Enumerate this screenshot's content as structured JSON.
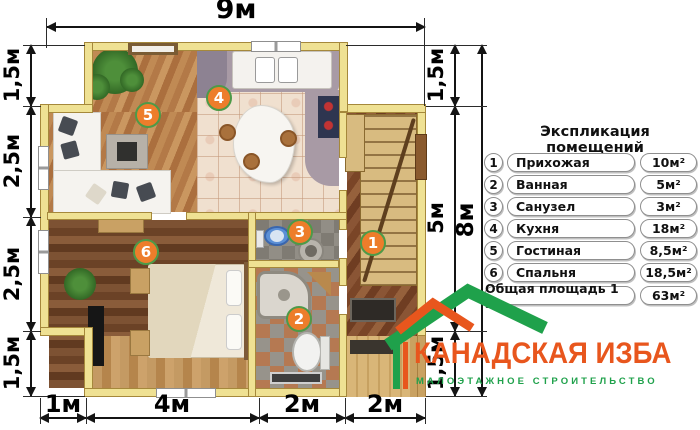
{
  "plan": {
    "dims": {
      "top": {
        "label": "9м"
      },
      "left": [
        {
          "label": "1,5м"
        },
        {
          "label": "2,5м"
        },
        {
          "label": "2,5м"
        },
        {
          "label": "1,5м"
        }
      ],
      "right_inner": [
        {
          "label": "1,5м"
        },
        {
          "label": "5м"
        },
        {
          "label": "1,5м"
        }
      ],
      "right_outer": {
        "label": "8м"
      },
      "bottom": [
        {
          "label": "1м"
        },
        {
          "label": "4м"
        },
        {
          "label": "2м"
        },
        {
          "label": "2м"
        }
      ]
    },
    "markers": [
      "1",
      "2",
      "3",
      "4",
      "5",
      "6"
    ]
  },
  "legend": {
    "title": "Экспликация помещений",
    "rows": [
      {
        "num": "1",
        "name": "Прихожая",
        "area": "10м²"
      },
      {
        "num": "2",
        "name": "Ванная",
        "area": "5м²"
      },
      {
        "num": "3",
        "name": "Санузел",
        "area": "3м²"
      },
      {
        "num": "4",
        "name": "Кухня",
        "area": "18м²"
      },
      {
        "num": "5",
        "name": "Гостиная",
        "area": "8,5м²"
      },
      {
        "num": "6",
        "name": "Спальня",
        "area": "18,5м²"
      }
    ],
    "total": {
      "name": "Общая площадь 1 эт",
      "area": "63м²"
    }
  },
  "logo": {
    "title": "КАНАДСКАЯ ИЗБА",
    "subtitle": "МАЛОЭТАЖНОЕ СТРОИТЕЛЬСТВО",
    "accent_orange": "#E8561D",
    "accent_green": "#1FA14B"
  }
}
